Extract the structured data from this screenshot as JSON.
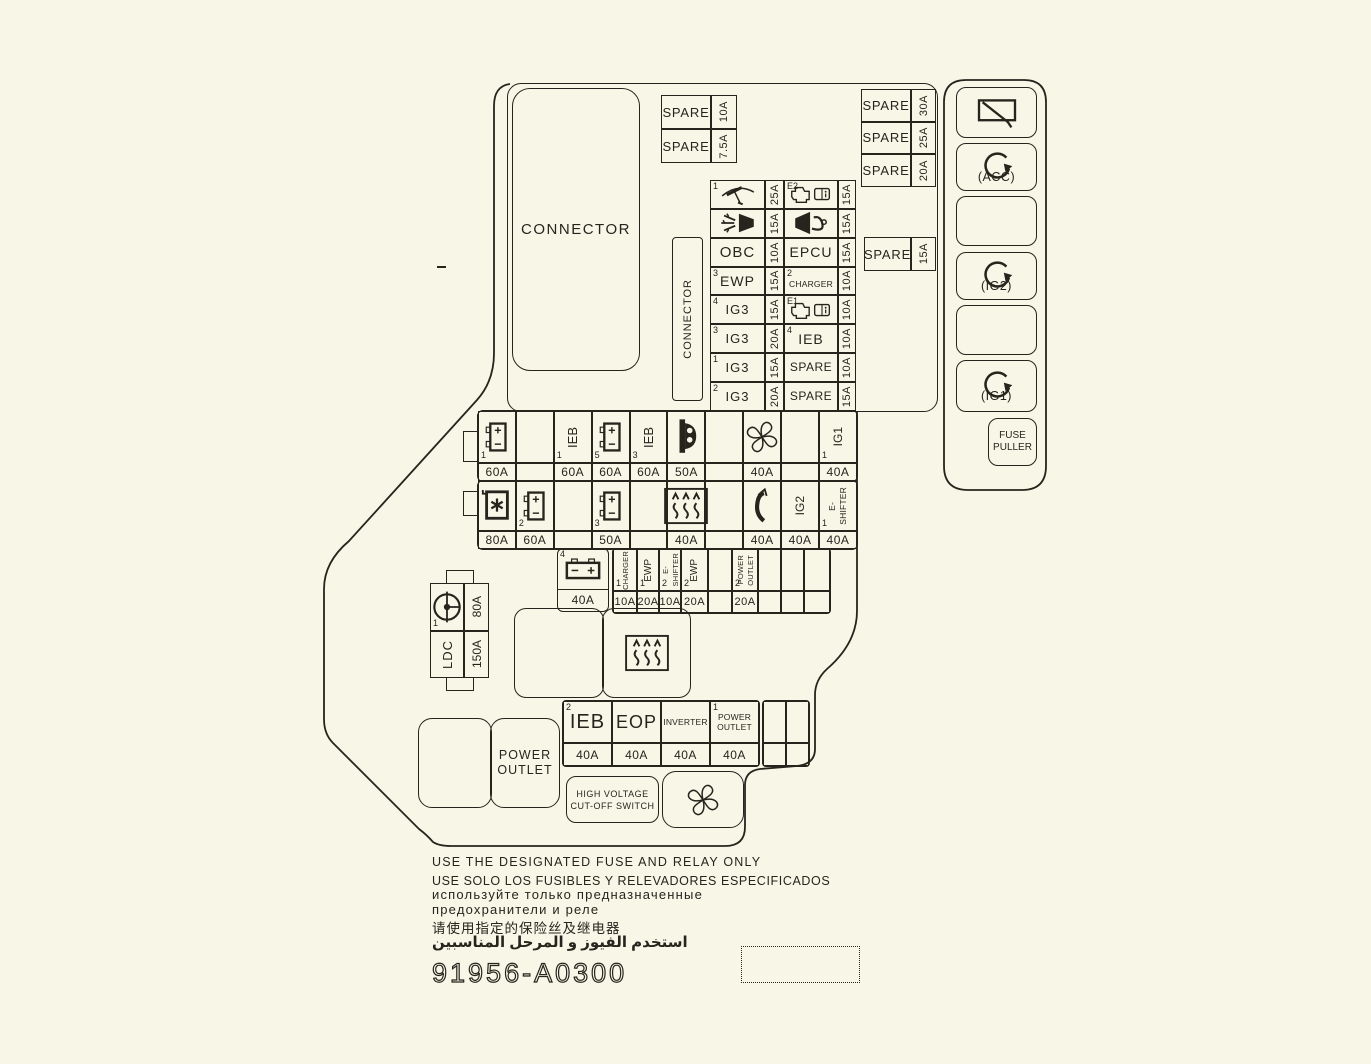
{
  "colors": {
    "background": "#f8f6e7",
    "line": "#26251d"
  },
  "top_left_spares": [
    {
      "label": "SPARE",
      "amp": "10A"
    },
    {
      "label": "SPARE",
      "amp": "7.5A"
    }
  ],
  "top_right_spares": [
    {
      "label": "SPARE",
      "amp": "30A"
    },
    {
      "label": "SPARE",
      "amp": "25A"
    },
    {
      "label": "SPARE",
      "amp": "20A"
    }
  ],
  "side_spare": {
    "label": "SPARE",
    "amp": "15A"
  },
  "connector_top": "CONNECTOR",
  "connector_vertical": "CONNECTOR",
  "grid": {
    "rows": [
      {
        "l_sup": "1",
        "l_icon": "wiper",
        "l_amp": "25A",
        "r_sup": "E2",
        "r_icon": "engine-book",
        "r_amp": "15A"
      },
      {
        "l_icon": "headlamp-washer",
        "l_amp": "15A",
        "r_icon": "horn",
        "r_amp": "15A"
      },
      {
        "l_label": "OBC",
        "l_amp": "10A",
        "r_label": "EPCU",
        "r_amp": "15A"
      },
      {
        "l_sup": "3",
        "l_label": "EWP",
        "l_amp": "15A",
        "r_sup": "2",
        "r_label": "CHARGER",
        "r_amp": "10A"
      },
      {
        "l_sup": "4",
        "l_label": "IG3",
        "l_amp": "15A",
        "r_sup": "E1",
        "r_icon": "engine-book",
        "r_amp": "10A"
      },
      {
        "l_sup": "3",
        "l_label": "IG3",
        "l_amp": "20A",
        "r_sup": "4",
        "r_label": "IEB",
        "r_amp": "10A"
      },
      {
        "l_sup": "1",
        "l_label": "IG3",
        "l_amp": "15A",
        "r_label": "SPARE",
        "r_amp": "10A"
      },
      {
        "l_sup": "2",
        "l_label": "IG3",
        "l_amp": "20A",
        "r_label": "SPARE",
        "r_amp": "15A"
      }
    ]
  },
  "row1": [
    {
      "icon": "battery",
      "sup": "1",
      "amp": "60A"
    },
    {},
    {
      "label": "IEB",
      "sup": "1",
      "amp": "60A"
    },
    {
      "icon": "battery",
      "sup": "5",
      "amp": "60A"
    },
    {
      "label": "IEB",
      "sup": "3",
      "amp": "60A"
    },
    {
      "icon": "charge-plug",
      "amp": "50A"
    },
    {},
    {
      "icon": "fan",
      "amp": "40A"
    },
    {},
    {
      "label": "IG1",
      "sup": "1",
      "amp": "40A"
    }
  ],
  "row2": [
    {
      "icon": "star-box",
      "amp": "80A"
    },
    {
      "icon": "battery",
      "sup": "2",
      "amp": "60A"
    },
    {},
    {
      "icon": "battery",
      "sup": "3",
      "amp": "50A"
    },
    {},
    {
      "icon": "defrost",
      "amp": "40A"
    },
    {},
    {
      "icon": "flap",
      "amp": "40A"
    },
    {
      "label": "IG2",
      "amp": "40A"
    },
    {
      "label": "E-",
      "label2": "SHIFTER",
      "sup": "1",
      "amp": "40A"
    }
  ],
  "row3": {
    "battery": {
      "icon": "battery-h",
      "sup": "4",
      "amp": "40A"
    },
    "cells": [
      {
        "label": "CHARGER",
        "sup": "1",
        "amp": "10A"
      },
      {
        "label": "EWP",
        "sup": "1",
        "amp": "20A"
      },
      {
        "label": "E-",
        "label2": "SHIFTER",
        "sup": "2",
        "amp": "10A"
      },
      {
        "label": "EWP",
        "sup": "2",
        "amp": "20A"
      },
      {},
      {
        "label": "POWER",
        "label2": "OUTLET",
        "sup": "2",
        "amp": "20A"
      },
      {},
      {},
      {}
    ]
  },
  "ldc": {
    "sup": "1",
    "icon": "pump",
    "amp_top": "80A",
    "label": "LDC",
    "amp_bottom": "150A"
  },
  "relay_big": {
    "right_icon": "defrost"
  },
  "ieb_row": [
    {
      "sup": "2",
      "label": "IEB",
      "amp": "40A"
    },
    {
      "label": "EOP",
      "amp": "40A"
    },
    {
      "label": "INVERTER",
      "amp": "40A"
    },
    {
      "sup": "1",
      "label": "POWER",
      "label2": "OUTLET",
      "amp": "40A"
    }
  ],
  "power_outlet_box": {
    "line1": "POWER",
    "line2": "OUTLET"
  },
  "hv_switch": {
    "line1": "HIGH VOLTAGE",
    "line2": "CUT-OFF SWITCH"
  },
  "fan_box": {
    "icon": "fan"
  },
  "relays": [
    {
      "icon": "rear-wiper",
      "label": ""
    },
    {
      "icon": "coil",
      "label": "(ACC)"
    },
    {
      "icon": "",
      "label": ""
    },
    {
      "icon": "coil",
      "label": "(IG2)"
    },
    {
      "icon": "",
      "label": ""
    },
    {
      "icon": "coil",
      "label": "(IG1)"
    }
  ],
  "fuse_puller": {
    "line1": "FUSE",
    "line2": "PULLER"
  },
  "footer": {
    "lines": [
      "USE THE DESIGNATED FUSE AND RELAY ONLY",
      "USE SOLO LOS FUSIBLES Y RELEVADORES ESPECIFICADOS",
      "используйте только предназначенные",
      "предохранители и реле",
      "请使用指定的保险丝及继电器",
      "استخدم الفيوز و المرحل المناسبين"
    ],
    "part_number": "91956-A0300"
  }
}
